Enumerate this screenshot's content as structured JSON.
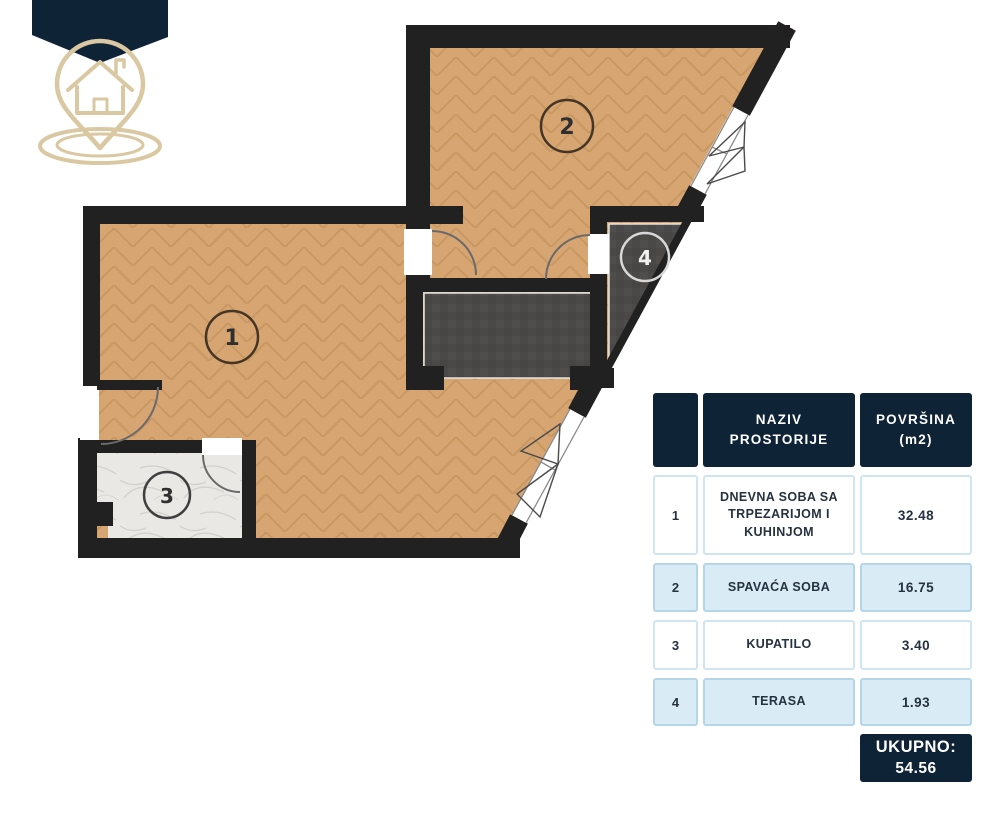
{
  "plan": {
    "room_labels": [
      "1",
      "2",
      "3",
      "4"
    ]
  },
  "table": {
    "header": {
      "col_name": "NAZIV\nPROSTORIJE",
      "col_area": "POVRŠINA\n(m2)"
    },
    "rows": [
      {
        "num": "1",
        "name": "DNEVNA SOBA SA TRPEZARIJOM I KUHINJOM",
        "area": "32.48"
      },
      {
        "num": "2",
        "name": "SPAVAĆA SOBA",
        "area": "16.75"
      },
      {
        "num": "3",
        "name": "KUPATILO",
        "area": "3.40"
      },
      {
        "num": "4",
        "name": "TERASA",
        "area": "1.93"
      }
    ],
    "total_label": "UKUPNO:",
    "total_value": "54.56"
  },
  "colors": {
    "navy": "#0f2337",
    "row_blue": "#d9ecf6",
    "wood_floor": "#d6a572",
    "dark_floor": "#4b4947",
    "wall": "#212121",
    "logo_beige": "#d9c8a2",
    "marble": "#e9e8e4"
  }
}
